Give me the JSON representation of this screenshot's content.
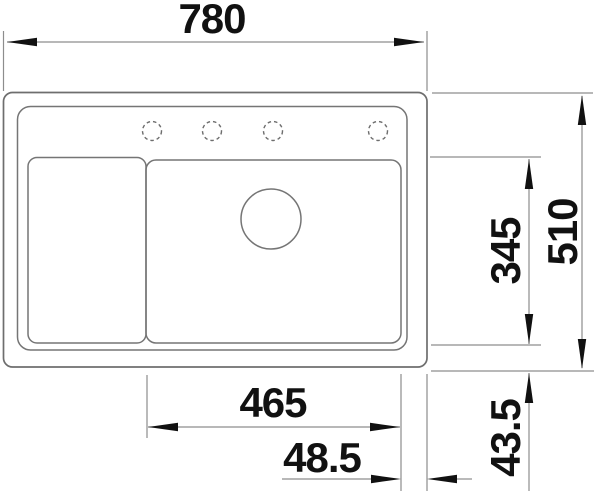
{
  "drawing": {
    "type": "technical-drawing",
    "subject": "kitchen sink top view with dimensions",
    "labels": {
      "width_total": "780",
      "depth_total": "510",
      "bowl_depth": "345",
      "bowl_width": "465",
      "edge_right": "48.5",
      "edge_front": "43.5"
    },
    "features": {
      "tap_holes": 4,
      "drain": "circle",
      "bowls": 2
    },
    "colors": {
      "object_line": "#6e6e6e",
      "dimension_line": "#8d8d8d",
      "text": "#111111",
      "background": "#ffffff"
    }
  }
}
